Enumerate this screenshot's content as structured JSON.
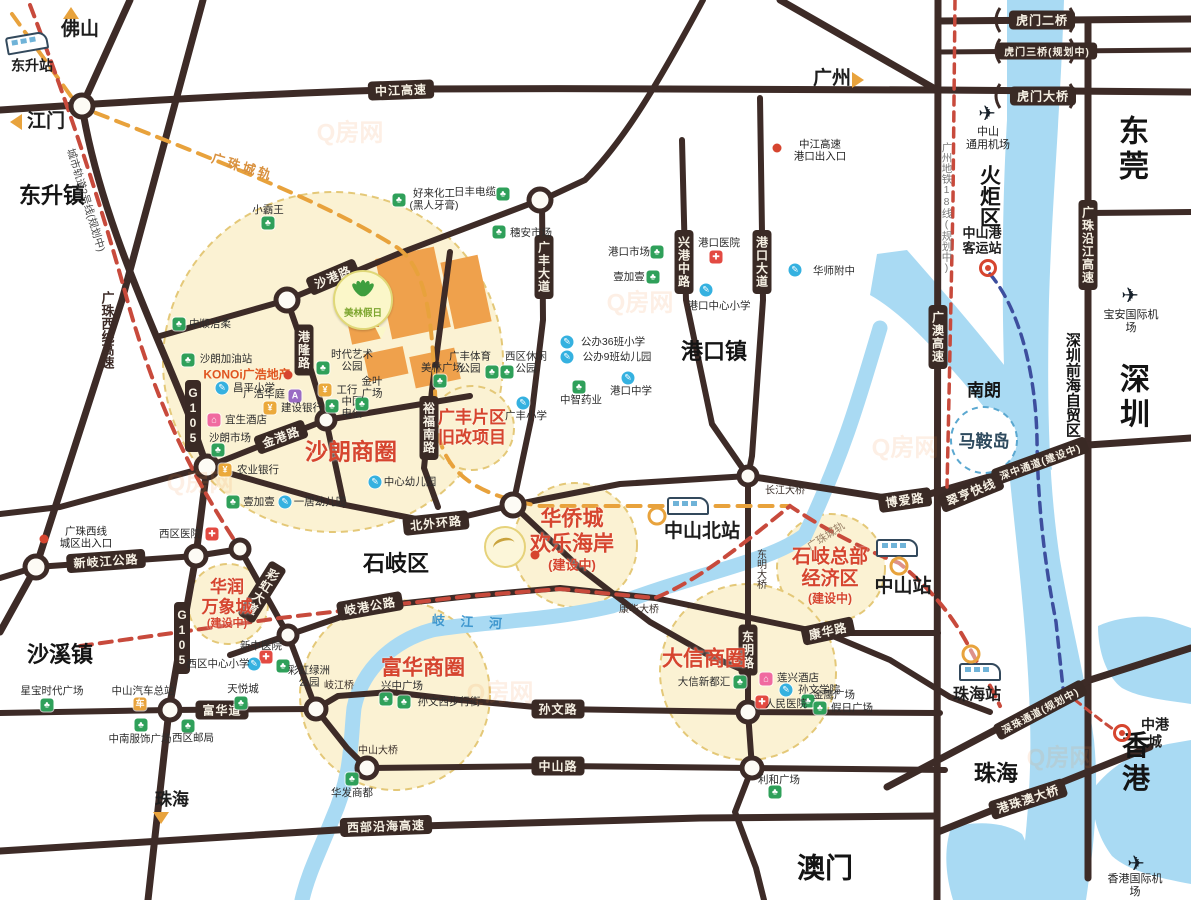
{
  "map": {
    "watermark": "Q房网",
    "watermark_spots": [
      [
        350,
        130
      ],
      [
        640,
        300
      ],
      [
        905,
        445
      ],
      [
        500,
        690
      ],
      [
        1060,
        755
      ],
      [
        200,
        480
      ]
    ],
    "regions": [
      {
        "t": "东莞",
        "x": 1134,
        "y": 150,
        "fs": 30
      },
      {
        "t": "深圳",
        "x": 1135,
        "y": 398,
        "fs": 30
      },
      {
        "t": "香港",
        "x": 1136,
        "y": 762,
        "fs": 28
      },
      {
        "t": "澳门",
        "x": 825,
        "y": 868,
        "fs": 28
      },
      {
        "t": "珠海",
        "x": 996,
        "y": 774,
        "fs": 22
      },
      {
        "t": "东升镇",
        "x": 52,
        "y": 196,
        "fs": 22
      },
      {
        "t": "沙溪镇",
        "x": 60,
        "y": 655,
        "fs": 22
      },
      {
        "t": "石岐区",
        "x": 396,
        "y": 564,
        "fs": 22
      },
      {
        "t": "港口镇",
        "x": 714,
        "y": 352,
        "fs": 22
      },
      {
        "t": "火炬区",
        "x": 988,
        "y": 196,
        "fs": 21,
        "vert": 1
      },
      {
        "t": "南朗",
        "x": 984,
        "y": 391,
        "fs": 17
      },
      {
        "t": "马鞍岛",
        "x": 984,
        "y": 442,
        "fs": 17,
        "color": "#2e4a5e"
      },
      {
        "t": "深圳前海自贸区",
        "x": 1072,
        "y": 385,
        "fs": 15,
        "vert": 1
      }
    ],
    "pills": [
      {
        "t": "中江高速",
        "x": 401,
        "y": 90,
        "rot": -2
      },
      {
        "t": "虎门二桥",
        "x": 1042,
        "y": 20
      },
      {
        "t": "虎门三桥(规划中)",
        "x": 1047,
        "y": 51,
        "fs": 10
      },
      {
        "t": "虎门大桥",
        "x": 1043,
        "y": 96
      },
      {
        "t": "沙港路",
        "x": 333,
        "y": 277,
        "rot": -23
      },
      {
        "t": "港隆路",
        "x": 304,
        "y": 350,
        "vert": 1
      },
      {
        "t": "广丰大道",
        "x": 544,
        "y": 267,
        "vert": 1
      },
      {
        "t": "兴港中路",
        "x": 684,
        "y": 262,
        "vert": 1
      },
      {
        "t": "港口大道",
        "x": 762,
        "y": 262,
        "vert": 1
      },
      {
        "t": "裕福南路",
        "x": 429,
        "y": 428,
        "vert": 1
      },
      {
        "t": "金港路",
        "x": 281,
        "y": 437,
        "rot": -20
      },
      {
        "t": "G105",
        "x": 193,
        "y": 416,
        "vert": 1
      },
      {
        "t": "G105",
        "x": 182,
        "y": 638,
        "vert": 1
      },
      {
        "t": "新岐江公路",
        "x": 106,
        "y": 561,
        "rot": -4
      },
      {
        "t": "北外环路",
        "x": 436,
        "y": 523,
        "rot": -6
      },
      {
        "t": "岐港公路",
        "x": 370,
        "y": 606,
        "rot": -10
      },
      {
        "t": "孙文路",
        "x": 558,
        "y": 709
      },
      {
        "t": "中山路",
        "x": 558,
        "y": 766
      },
      {
        "t": "富华道",
        "x": 222,
        "y": 710
      },
      {
        "t": "西部沿海高速",
        "x": 386,
        "y": 826,
        "rot": -2
      },
      {
        "t": "康华路",
        "x": 828,
        "y": 631,
        "rot": -12
      },
      {
        "t": "博爱路",
        "x": 905,
        "y": 500,
        "rot": -8
      },
      {
        "t": "翠亨快线",
        "x": 971,
        "y": 492,
        "rot": -22
      },
      {
        "t": "深中通道(建设中)",
        "x": 1040,
        "y": 461,
        "rot": -20,
        "fs": 10
      },
      {
        "t": "深珠通道(规划中)",
        "x": 1040,
        "y": 710,
        "rot": -28,
        "fs": 10
      },
      {
        "t": "港珠澳大桥",
        "x": 1028,
        "y": 799,
        "rot": -18
      },
      {
        "t": "广澳高速",
        "x": 938,
        "y": 337,
        "vert": 1
      },
      {
        "t": "广珠沿江高速",
        "x": 1088,
        "y": 245,
        "vert": 1
      },
      {
        "t": "东明路",
        "x": 748,
        "y": 650,
        "vert": 1
      },
      {
        "t": "彩虹大道",
        "x": 262,
        "y": 592,
        "vert": 1,
        "rot": 32
      }
    ],
    "roadtexts": [
      {
        "t": "岐江桥",
        "x": 339,
        "y": 684,
        "fs": 10
      },
      {
        "t": "中山大桥",
        "x": 378,
        "y": 749,
        "fs": 10
      },
      {
        "t": "康华大桥",
        "x": 639,
        "y": 608,
        "fs": 10
      },
      {
        "t": "长江大桥",
        "x": 785,
        "y": 489,
        "fs": 10
      },
      {
        "t": "东明大桥",
        "x": 760,
        "y": 569,
        "fs": 10,
        "vert": 1
      },
      {
        "t": "广珠西线高速",
        "x": 107,
        "y": 330,
        "fs": 13,
        "vert": 1,
        "color": "#3d2b27",
        "bold": 1
      },
      {
        "t": "城市轨道2号线(规划中)",
        "x": 86,
        "y": 200,
        "fs": 10.5,
        "rot": 73,
        "color": "#4a4a4a"
      },
      {
        "t": "广珠城轨",
        "x": 243,
        "y": 166,
        "rot": 17,
        "fs": 13,
        "color": "#d9913f",
        "ls": 3,
        "bold": 1
      },
      {
        "t": "广珠城轨",
        "x": 826,
        "y": 536,
        "rot": -33,
        "fs": 10.5,
        "color": "#9b8268"
      },
      {
        "t": "广州地铁18线(规划中)",
        "x": 947,
        "y": 208,
        "vert": 1,
        "fs": 10.5,
        "color": "#7a7a7a"
      },
      {
        "t": "岐 江 河",
        "x": 470,
        "y": 621,
        "rot": 3,
        "fs": 13,
        "color": "#3f97ce",
        "ls": 6,
        "bold": 1
      },
      {
        "t": "KONOi广浩地产",
        "x": 247,
        "y": 374,
        "fs": 12,
        "color": "#e05520",
        "bold": 1
      }
    ],
    "zones": [
      {
        "lines": [
          "沙朗商圈"
        ],
        "x": 351,
        "y": 452,
        "fs": 23
      },
      {
        "lines": [
          "广丰片区",
          "旧改项目"
        ],
        "x": 472,
        "y": 428,
        "fs": 17
      },
      {
        "lines": [
          "华侨城",
          "欢乐海岸",
          "(建设中)"
        ],
        "x": 572,
        "y": 540,
        "fs": 21
      },
      {
        "lines": [
          "石岐总部",
          "经济区",
          "(建设中)"
        ],
        "x": 830,
        "y": 576,
        "fs": 19
      },
      {
        "lines": [
          "华润",
          "万象城",
          "(建设中)"
        ],
        "x": 227,
        "y": 604,
        "fs": 17
      },
      {
        "lines": [
          "富华商圈"
        ],
        "x": 423,
        "y": 669,
        "fs": 21
      },
      {
        "lines": [
          "大信商圈"
        ],
        "x": 704,
        "y": 660,
        "fs": 21
      }
    ],
    "pois": [
      {
        "t": "中顺洁柔",
        "k": "g",
        "ix": 179,
        "iy": 324,
        "lx": 210,
        "ly": 324
      },
      {
        "t": "小霸王",
        "k": "g",
        "ix": 268,
        "iy": 223,
        "lx": 268,
        "ly": 210
      },
      {
        "t": "好来化工\n(黑人牙膏)",
        "k": "g",
        "ix": 399,
        "iy": 200,
        "lx": 434,
        "ly": 200
      },
      {
        "t": "日丰电缆",
        "k": "g",
        "ix": 503,
        "iy": 194,
        "lx": 475,
        "ly": 192
      },
      {
        "t": "穗安市场",
        "k": "g",
        "ix": 499,
        "iy": 232,
        "lx": 531,
        "ly": 233
      },
      {
        "t": "沙朗加油站",
        "k": "g",
        "ix": 188,
        "iy": 360,
        "lx": 226,
        "ly": 359
      },
      {
        "t": "昌平小学",
        "k": "b",
        "ix": 222,
        "iy": 388,
        "lx": 254,
        "ly": 388
      },
      {
        "t": "广浩华庭",
        "k": "e",
        "ix": 295,
        "iy": 396,
        "lx": 264,
        "ly": 394
      },
      {
        "t": "建设银行",
        "k": "k",
        "ix": 270,
        "iy": 408,
        "lx": 302,
        "ly": 408
      },
      {
        "t": "宜生酒店",
        "k": "p",
        "ix": 214,
        "iy": 420,
        "lx": 246,
        "ly": 420
      },
      {
        "t": "沙朗市场",
        "k": "g",
        "ix": 218,
        "iy": 450,
        "lx": 230,
        "ly": 438
      },
      {
        "t": "农业银行",
        "k": "k",
        "ix": 225,
        "iy": 470,
        "lx": 258,
        "ly": 470
      },
      {
        "t": "壹加壹",
        "k": "g",
        "ix": 233,
        "iy": 502,
        "lx": 259,
        "ly": 502
      },
      {
        "t": "一居幼儿园",
        "k": "b",
        "ix": 285,
        "iy": 502,
        "lx": 320,
        "ly": 502
      },
      {
        "t": "中心幼儿园",
        "k": "b",
        "ix": 375,
        "iy": 482,
        "lx": 410,
        "ly": 482
      },
      {
        "t": "时代艺术\n公园",
        "k": "g",
        "ix": 323,
        "iy": 368,
        "lx": 352,
        "ly": 361
      },
      {
        "t": "工行",
        "k": "k",
        "ix": 325,
        "iy": 390,
        "lx": 347,
        "ly": 390
      },
      {
        "t": "中国\n电信",
        "k": "g",
        "ix": 332,
        "iy": 406,
        "lx": 352,
        "ly": 408
      },
      {
        "t": "金叶\n广场",
        "k": "g",
        "ix": 362,
        "iy": 404,
        "lx": 372,
        "ly": 388
      },
      {
        "t": "美林广场",
        "k": "g",
        "ix": 440,
        "iy": 381,
        "lx": 442,
        "ly": 368
      },
      {
        "t": "广丰体育\n公园",
        "k": "g",
        "ix": 492,
        "iy": 372,
        "lx": 470,
        "ly": 363
      },
      {
        "t": "西区休闲\n公园",
        "k": "g",
        "ix": 507,
        "iy": 372,
        "lx": 526,
        "ly": 363
      },
      {
        "t": "公办36班小学",
        "k": "b",
        "ix": 567,
        "iy": 342,
        "lx": 613,
        "ly": 342
      },
      {
        "t": "公办9班幼儿园",
        "k": "b",
        "ix": 567,
        "iy": 357,
        "lx": 617,
        "ly": 357
      },
      {
        "t": "中智药业",
        "k": "g",
        "ix": 579,
        "iy": 387,
        "lx": 581,
        "ly": 400
      },
      {
        "t": "广丰小学",
        "k": "b",
        "ix": 523,
        "iy": 403,
        "lx": 526,
        "ly": 416
      },
      {
        "t": "港口中学",
        "k": "b",
        "ix": 628,
        "iy": 378,
        "lx": 631,
        "ly": 391
      },
      {
        "t": "港口市场",
        "k": "g",
        "ix": 657,
        "iy": 252,
        "lx": 629,
        "ly": 252
      },
      {
        "t": "壹加壹",
        "k": "g",
        "ix": 653,
        "iy": 277,
        "lx": 629,
        "ly": 277
      },
      {
        "t": "港口医院",
        "k": "h",
        "ix": 716,
        "iy": 257,
        "lx": 719,
        "ly": 243
      },
      {
        "t": "港口中心小学",
        "k": "b",
        "ix": 706,
        "iy": 290,
        "lx": 719,
        "ly": 306
      },
      {
        "t": "华师附中",
        "k": "b",
        "ix": 795,
        "iy": 270,
        "lx": 834,
        "ly": 271
      },
      {
        "t": "西区医院",
        "k": "h",
        "ix": 212,
        "iy": 534,
        "lx": 180,
        "ly": 534
      },
      {
        "t": "新中医院",
        "k": "h",
        "ix": 266,
        "iy": 657,
        "lx": 261,
        "ly": 646
      },
      {
        "t": "西区中心小学",
        "k": "b",
        "ix": 254,
        "iy": 664,
        "lx": 218,
        "ly": 664
      },
      {
        "t": "彩虹绿洲\n公园",
        "k": "g",
        "ix": 283,
        "iy": 666,
        "lx": 309,
        "ly": 677
      },
      {
        "t": "天悦城",
        "k": "g",
        "ix": 241,
        "iy": 703,
        "lx": 243,
        "ly": 689
      },
      {
        "t": "星宝时代广场",
        "k": "g",
        "ix": 47,
        "iy": 705,
        "lx": 52,
        "ly": 691
      },
      {
        "t": "中山汽车总站",
        "k": "u",
        "ix": 140,
        "iy": 704,
        "lx": 143,
        "ly": 691
      },
      {
        "t": "中南服饰广场",
        "k": "g",
        "ix": 141,
        "iy": 725,
        "lx": 140,
        "ly": 739
      },
      {
        "t": "西区邮局",
        "k": "g",
        "ix": 188,
        "iy": 726,
        "lx": 193,
        "ly": 738
      },
      {
        "t": "兴中广场",
        "k": "g",
        "ix": 386,
        "iy": 699,
        "lx": 402,
        "ly": 686
      },
      {
        "t": "孙文西步行街",
        "k": "g",
        "ix": 404,
        "iy": 702,
        "lx": 449,
        "ly": 702
      },
      {
        "t": "华发商都",
        "k": "g",
        "ix": 352,
        "iy": 779,
        "lx": 352,
        "ly": 793
      },
      {
        "t": "大信新都汇",
        "k": "g",
        "ix": 740,
        "iy": 682,
        "lx": 704,
        "ly": 682
      },
      {
        "t": "莲兴酒店",
        "k": "p",
        "ix": 766,
        "iy": 679,
        "lx": 798,
        "ly": 678
      },
      {
        "t": "孙文学院",
        "k": "b",
        "ix": 786,
        "iy": 690,
        "lx": 819,
        "ly": 690
      },
      {
        "t": "金鹰广场",
        "k": "g",
        "ix": 808,
        "iy": 701,
        "lx": 834,
        "ly": 695
      },
      {
        "t": "人民医院",
        "k": "h",
        "ix": 762,
        "iy": 702,
        "lx": 786,
        "ly": 704
      },
      {
        "t": "假日广场",
        "k": "g",
        "ix": 820,
        "iy": 708,
        "lx": 852,
        "ly": 708
      },
      {
        "t": "利和广场",
        "k": "g",
        "ix": 775,
        "iy": 792,
        "lx": 779,
        "ly": 780
      }
    ],
    "stations": [
      {
        "t": "东升站",
        "x": 32,
        "y": 66,
        "fs": 14,
        "train": [
          27,
          43
        ],
        "rot": -10
      },
      {
        "t": "中山北站",
        "x": 702,
        "y": 532,
        "fs": 19,
        "train": [
          688,
          506
        ],
        "ring": [
          657,
          516
        ]
      },
      {
        "t": "中山站",
        "x": 903,
        "y": 587,
        "fs": 19,
        "train": [
          897,
          548
        ],
        "ring": [
          899,
          566
        ]
      },
      {
        "t": "珠海站",
        "x": 977,
        "y": 696,
        "fs": 16,
        "train": [
          980,
          672
        ],
        "ring": [
          971,
          654
        ]
      },
      {
        "t": "中山港\n客运站",
        "x": 982,
        "y": 241,
        "fs": 13,
        "target": [
          988,
          268
        ]
      }
    ],
    "airports": [
      {
        "t": "中山\n通用机场",
        "x": 988,
        "y": 139,
        "px": 987,
        "py": 114
      },
      {
        "t": "宝安国际机场",
        "x": 1131,
        "y": 322,
        "px": 1130,
        "py": 296
      },
      {
        "t": "香港国际机场",
        "x": 1135,
        "y": 886,
        "px": 1136,
        "py": 864
      }
    ],
    "arrows": [
      {
        "t": "佛山",
        "x": 80,
        "y": 30,
        "ax": 71,
        "ay": 13,
        "dir": "up",
        "fs": 19
      },
      {
        "t": "江门",
        "x": 46,
        "y": 122,
        "ax": 16,
        "ay": 122,
        "dir": "left",
        "fs": 19
      },
      {
        "t": "广州",
        "x": 832,
        "y": 79,
        "ax": 858,
        "ay": 80,
        "dir": "right",
        "fs": 19
      },
      {
        "t": "珠海",
        "x": 172,
        "y": 800,
        "ax": 161,
        "ay": 818,
        "dir": "down",
        "fs": 17
      }
    ],
    "markers": [
      {
        "kind": "dot",
        "x": 777,
        "y": 148,
        "label": "中江高速\n港口出入口",
        "lx": 820,
        "ly": 151
      },
      {
        "kind": "dot",
        "x": 44,
        "y": 539,
        "label": "广珠西线\n城区出入口",
        "lx": 86,
        "ly": 538
      },
      {
        "kind": "dot",
        "x": 288,
        "y": 375
      },
      {
        "kind": "dot",
        "x": 535,
        "y": 555
      },
      {
        "kind": "target",
        "x": 1122,
        "y": 733,
        "label": "中港城",
        "lx": 1155,
        "ly": 733,
        "fs": 14
      }
    ],
    "logos": {
      "meilin": {
        "text": "美林假日",
        "x": 363,
        "y": 300
      },
      "oct": {
        "x": 505,
        "y": 547
      }
    }
  }
}
